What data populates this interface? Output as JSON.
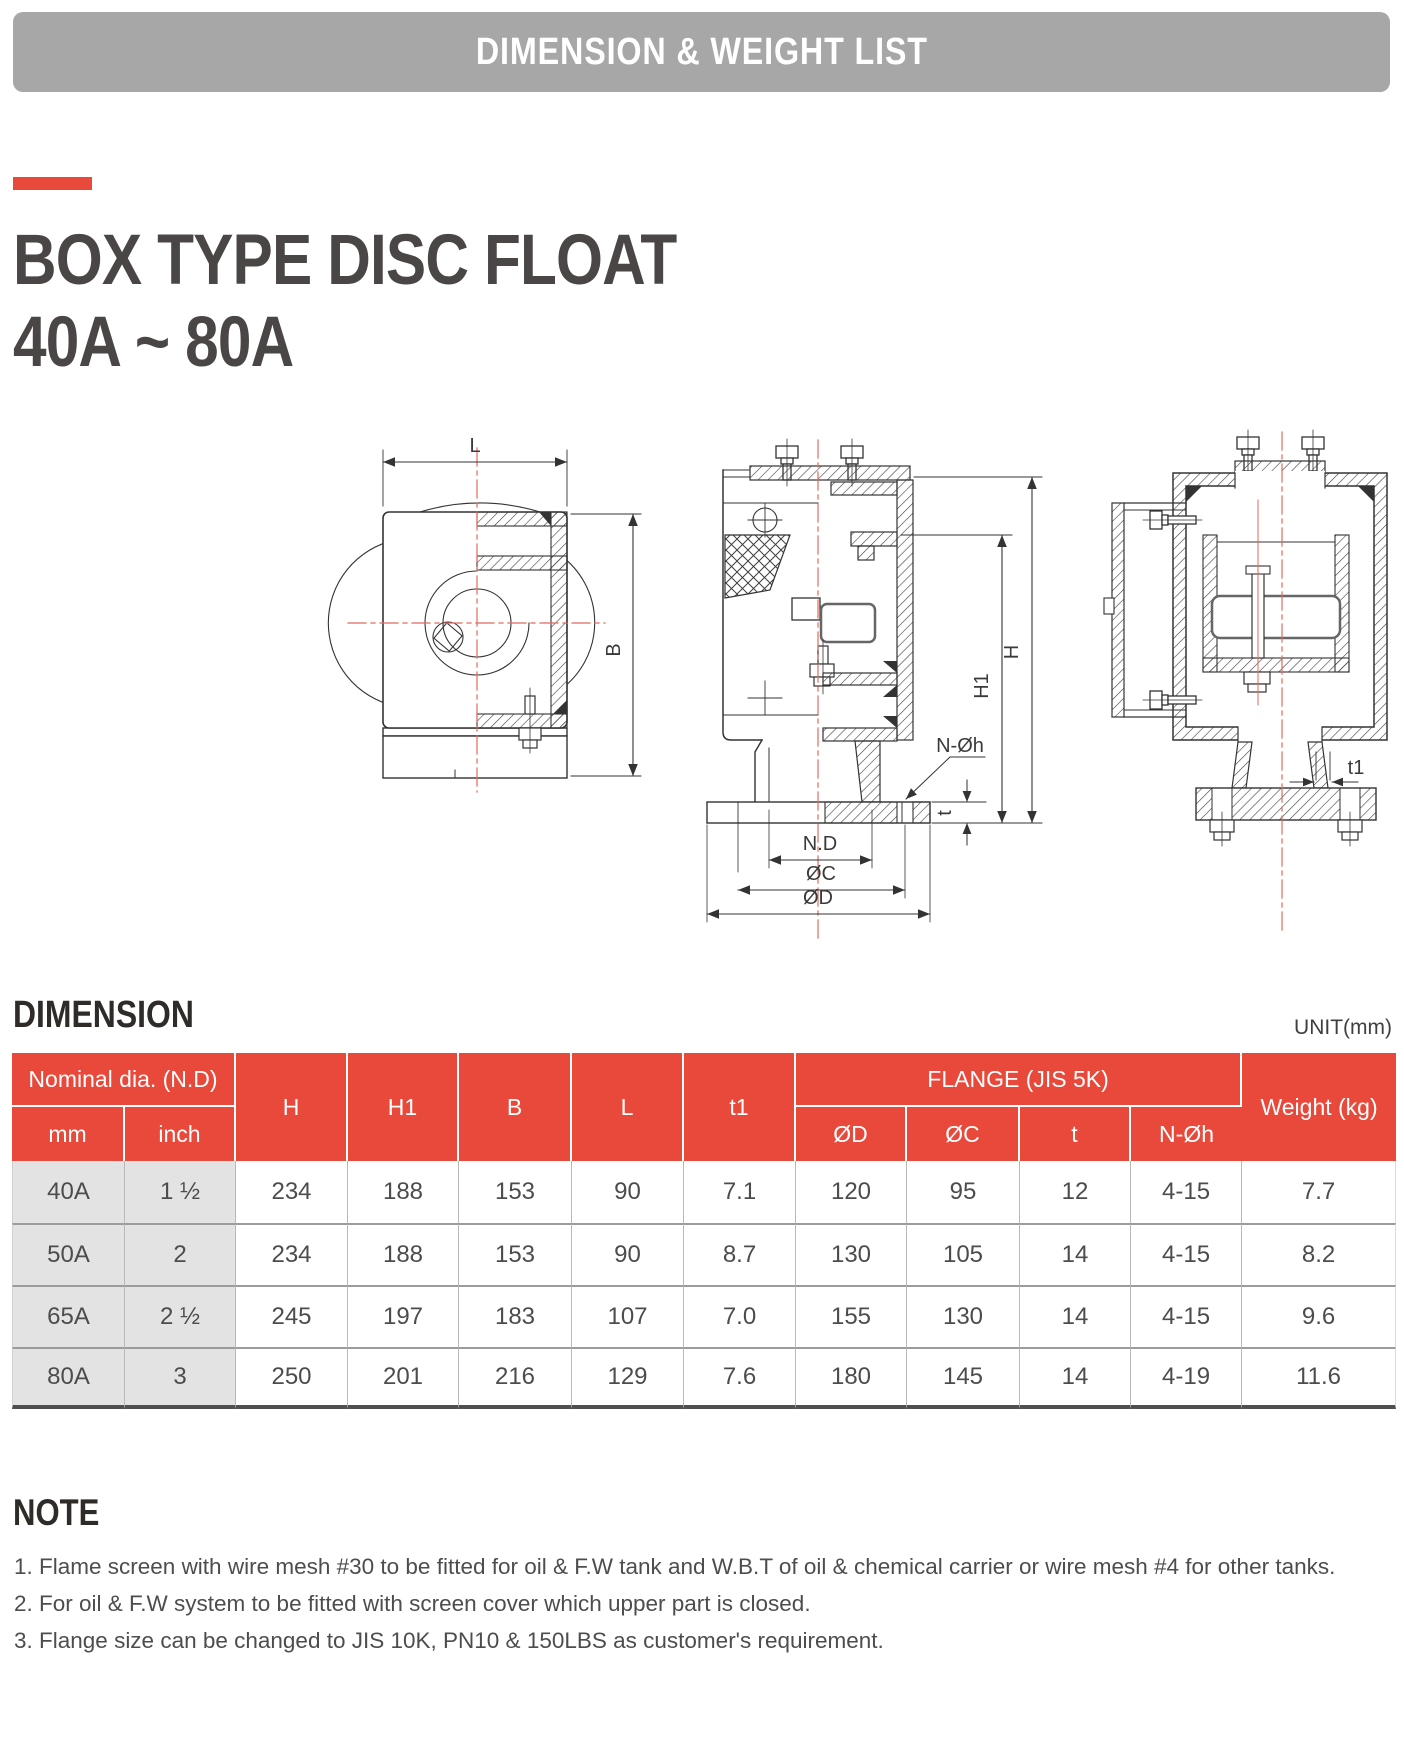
{
  "banner": {
    "title": "DIMENSION & WEIGHT LIST"
  },
  "product": {
    "title_line1": "BOX TYPE DISC FLOAT",
    "title_line2": "40A ~ 80A"
  },
  "drawings": {
    "labels": {
      "l": "L",
      "b": "B",
      "h": "H",
      "h1": "H1",
      "t": "t",
      "t1": "t1",
      "nd": "N.D",
      "oc": "ØC",
      "od": "ØD",
      "noh": "N-Øh"
    }
  },
  "dimension_section": {
    "heading": "DIMENSION",
    "unit_label": "UNIT(mm)"
  },
  "table": {
    "header": {
      "nominal_dia": "Nominal dia. (N.D)",
      "mm": "mm",
      "inch": "inch",
      "h": "H",
      "h1": "H1",
      "b": "B",
      "l": "L",
      "t1": "t1",
      "flange": "FLANGE (JIS 5K)",
      "od": "ØD",
      "oc": "ØC",
      "t": "t",
      "n_oh": "N-Øh",
      "weight": "Weight (kg)"
    },
    "rows": [
      {
        "mm": "40A",
        "inch": "1 ½",
        "h": "234",
        "h1": "188",
        "b": "153",
        "l": "90",
        "t1": "7.1",
        "od": "120",
        "oc": "95",
        "t": "12",
        "n_oh": "4-15",
        "weight": "7.7"
      },
      {
        "mm": "50A",
        "inch": "2",
        "h": "234",
        "h1": "188",
        "b": "153",
        "l": "90",
        "t1": "8.7",
        "od": "130",
        "oc": "105",
        "t": "14",
        "n_oh": "4-15",
        "weight": "8.2"
      },
      {
        "mm": "65A",
        "inch": "2 ½",
        "h": "245",
        "h1": "197",
        "b": "183",
        "l": "107",
        "t1": "7.0",
        "od": "155",
        "oc": "130",
        "t": "14",
        "n_oh": "4-15",
        "weight": "9.6"
      },
      {
        "mm": "80A",
        "inch": "3",
        "h": "250",
        "h1": "201",
        "b": "216",
        "l": "129",
        "t1": "7.6",
        "od": "180",
        "oc": "145",
        "t": "14",
        "n_oh": "4-19",
        "weight": "11.6"
      }
    ]
  },
  "note": {
    "heading": "NOTE",
    "items": [
      "1. Flame screen with wire mesh #30 to be fitted for oil & F.W tank and W.B.T of oil & chemical carrier or wire mesh #4 for other tanks.",
      "2. For oil & F.W system to be fitted with screen cover which upper part is closed.",
      "3. Flange size can be changed to JIS 10K, PN10 & 150LBS as customer's requirement."
    ]
  },
  "colors": {
    "accent_red": "#e8493b",
    "banner_gray": "#a7a7a7",
    "row_shade": "#e3e3e3",
    "centerline_red": "#e16a5e"
  }
}
